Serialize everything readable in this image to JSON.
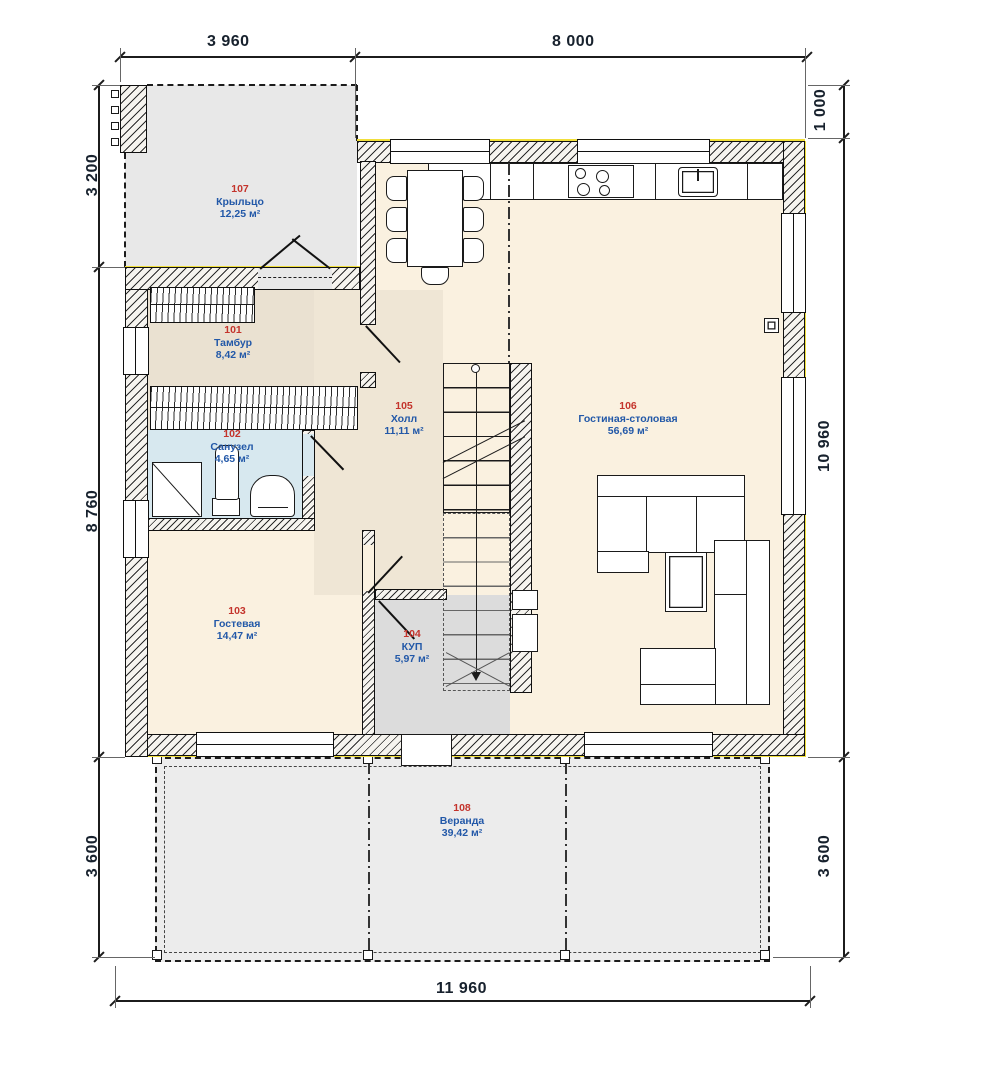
{
  "plan": {
    "title": "План 1 этажа",
    "dimensions": {
      "top": [
        "3 960",
        "8 000"
      ],
      "bottom": [
        "11 960"
      ],
      "left": [
        "3 200",
        "8 760",
        "3 600"
      ],
      "right": [
        "1 000",
        "10 960",
        "3 600"
      ]
    },
    "rooms": [
      {
        "number": "101",
        "name": "Тамбур",
        "area": "8,42 м²"
      },
      {
        "number": "102",
        "name": "Санузел",
        "area": "4,65 м²"
      },
      {
        "number": "103",
        "name": "Гостевая",
        "area": "14,47 м²"
      },
      {
        "number": "104",
        "name": "КУП",
        "area": "5,97 м²"
      },
      {
        "number": "105",
        "name": "Холл",
        "area": "11,11 м²"
      },
      {
        "number": "106",
        "name": "Гостиная-столовая",
        "area": "56,69 м²"
      },
      {
        "number": "107",
        "name": "Крыльцо",
        "area": "12,25 м²"
      },
      {
        "number": "108",
        "name": "Веранда",
        "area": "39,42 м²"
      }
    ],
    "colors": {
      "insulation": "#f1df3b",
      "wall_fill": "#f6f4ef",
      "floor_warm": "#faf1e0",
      "floor_muted": "#eae1d1",
      "floor_bath": "#d7e8ef",
      "floor_gray": "#e8e8e8",
      "floor_utility": "#dcdcdc",
      "room_number": "#c4342c",
      "room_name": "#2258a8",
      "dimension_text": "#17212d"
    }
  }
}
